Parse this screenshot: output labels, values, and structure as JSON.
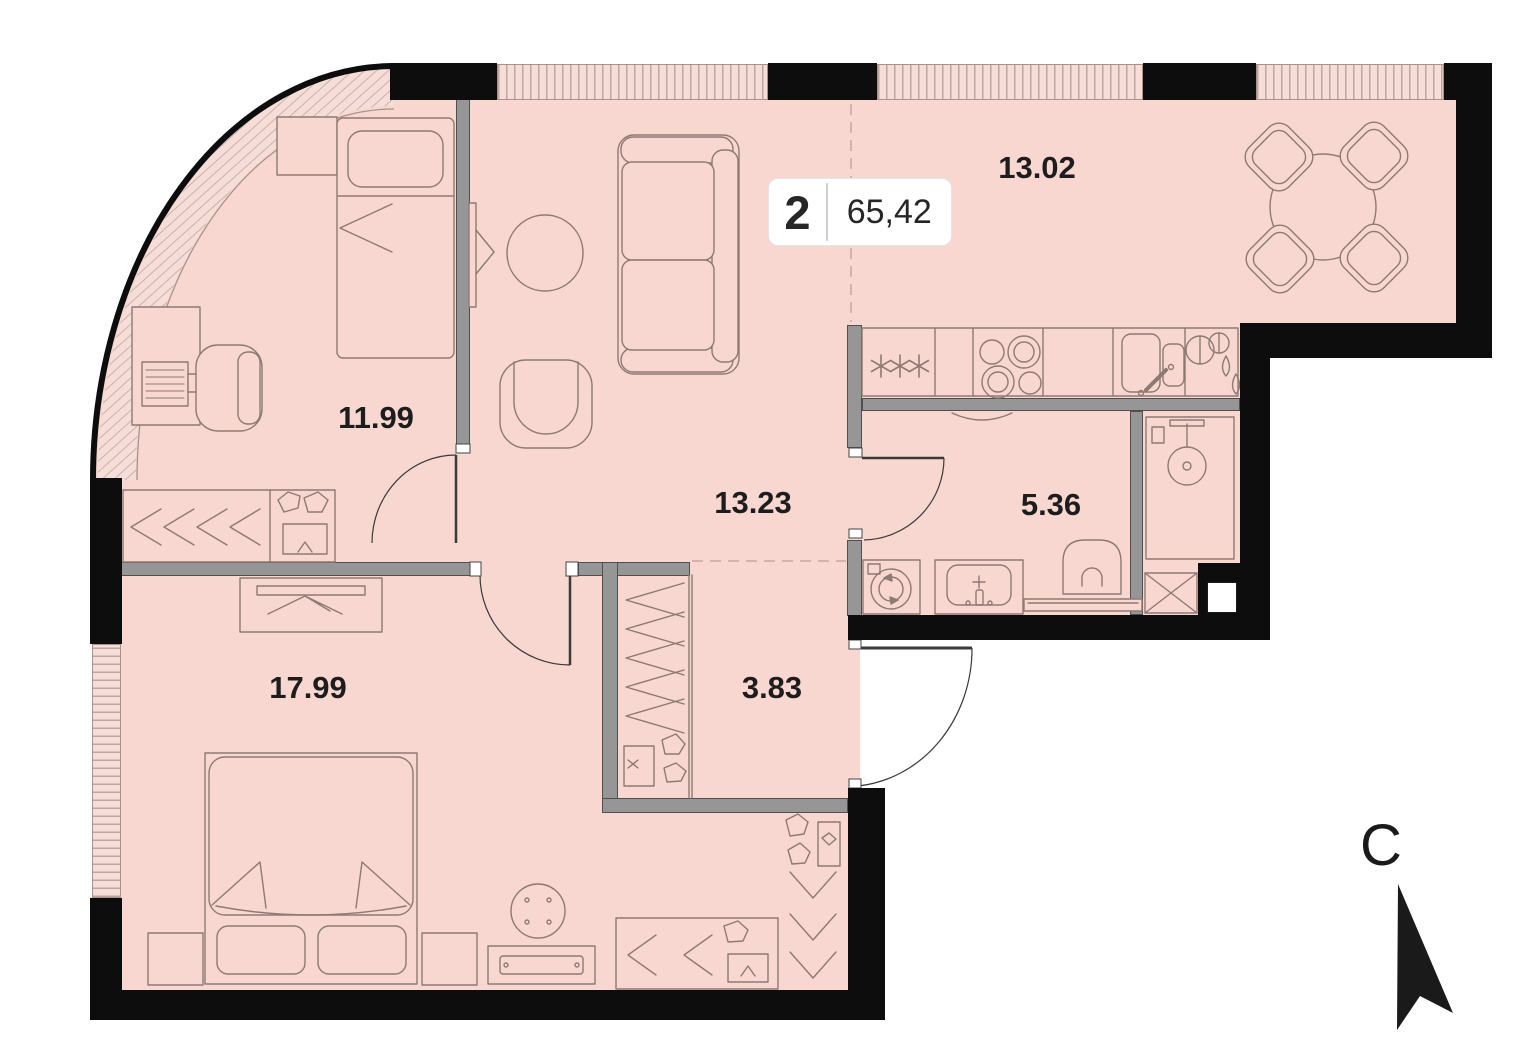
{
  "badge": {
    "rooms_count": "2",
    "area": "65,42"
  },
  "rooms": [
    {
      "name": "kitchen-dining",
      "area_label": "13.02"
    },
    {
      "name": "bedroom-secondary",
      "area_label": "11.99"
    },
    {
      "name": "hallway",
      "area_label": "13.23"
    },
    {
      "name": "bathroom",
      "area_label": "5.36"
    },
    {
      "name": "bedroom-master",
      "area_label": "17.99"
    },
    {
      "name": "closet-hall",
      "area_label": "3.83"
    }
  ],
  "compass": {
    "north_label": "С"
  },
  "colors": {
    "floor": "#f8d7d0",
    "wall": "#0d0d0d",
    "partition": "#969696",
    "furniture_line": "#8d7a72",
    "window_line": "#bda89f"
  }
}
